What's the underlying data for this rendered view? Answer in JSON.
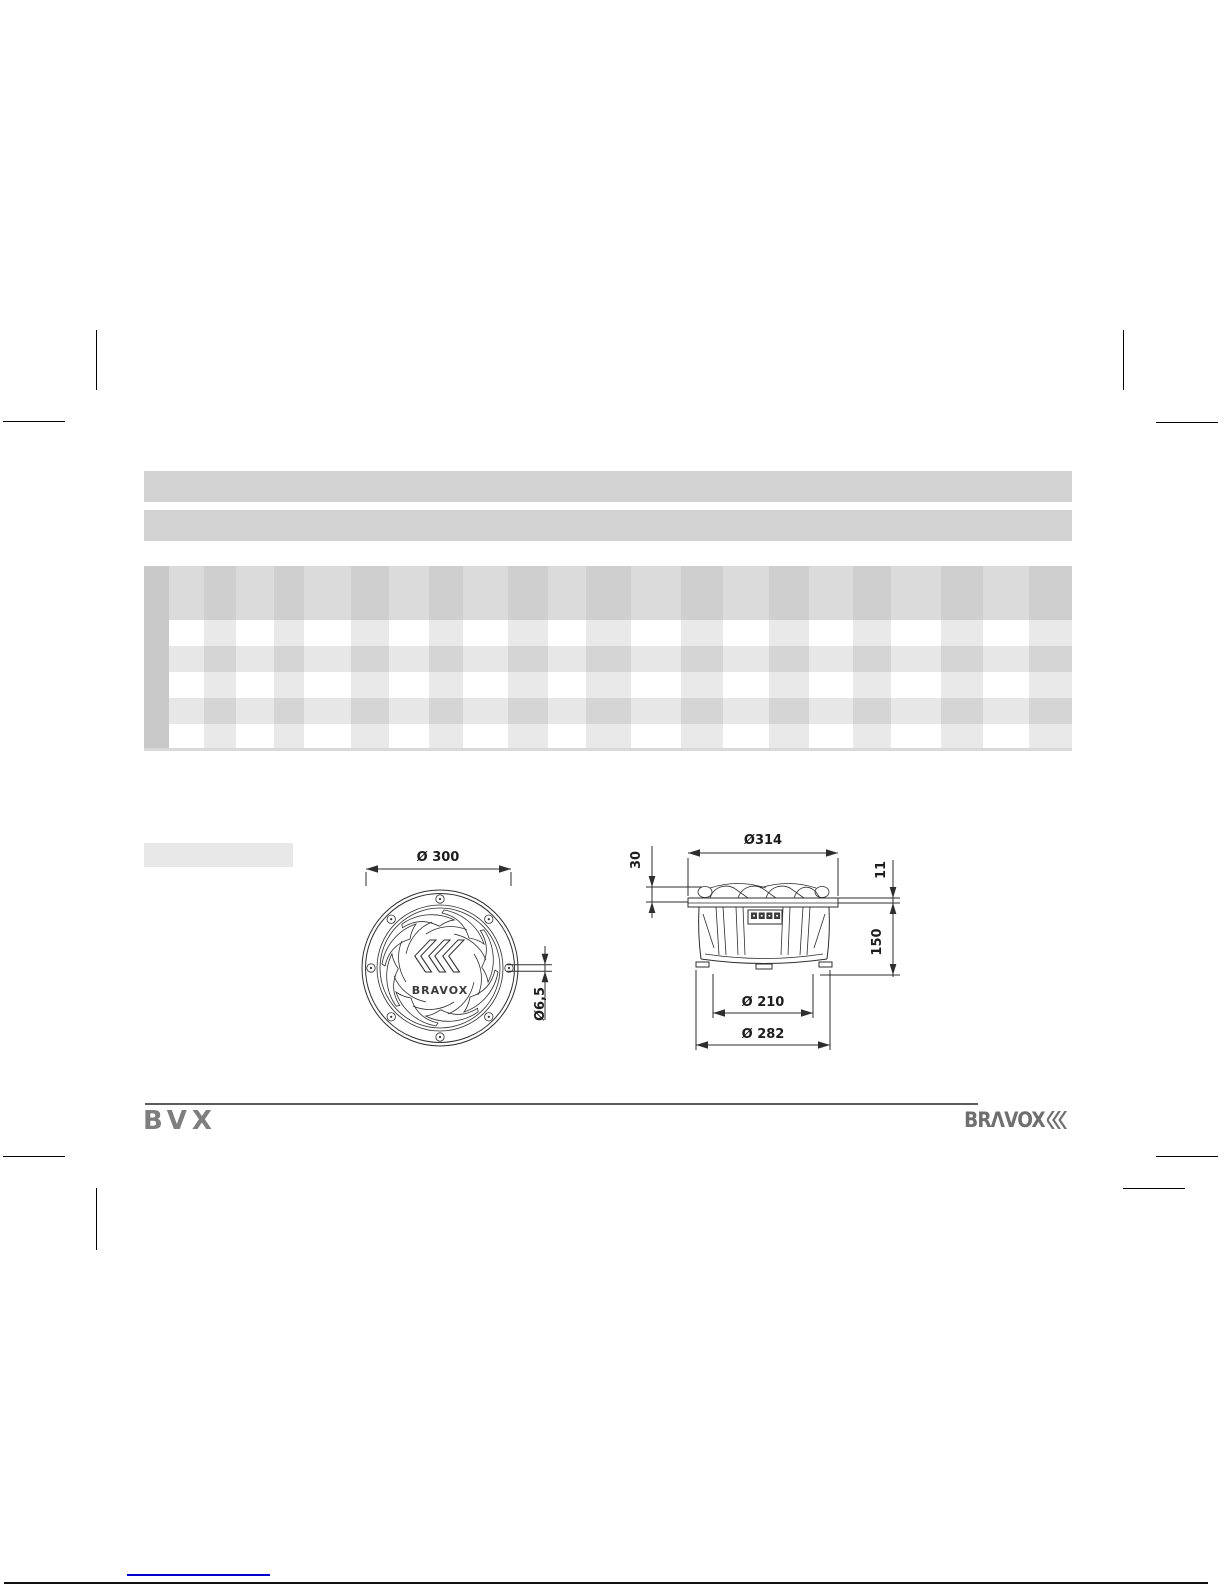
{
  "drawings": {
    "front_view": {
      "dim_flange_diameter": "Ø 300",
      "dim_screw_hole": "Ø6,5",
      "logo_text": "BRAVOX"
    },
    "side_view": {
      "dim_overall_diameter": "Ø314",
      "dim_top_height": "30",
      "dim_flange_thickness": "11",
      "dim_mounting_depth": "150",
      "dim_cutout_diameter": "Ø 210",
      "dim_basket_diameter": "Ø 282"
    }
  },
  "footer": {
    "product_line": "BVX",
    "brand": "BRΛVOX"
  },
  "colors": {
    "placeholder_bar": "#d2d2d2",
    "table_label_col": "#c9c9c9",
    "link_blue": "#0000cc"
  }
}
